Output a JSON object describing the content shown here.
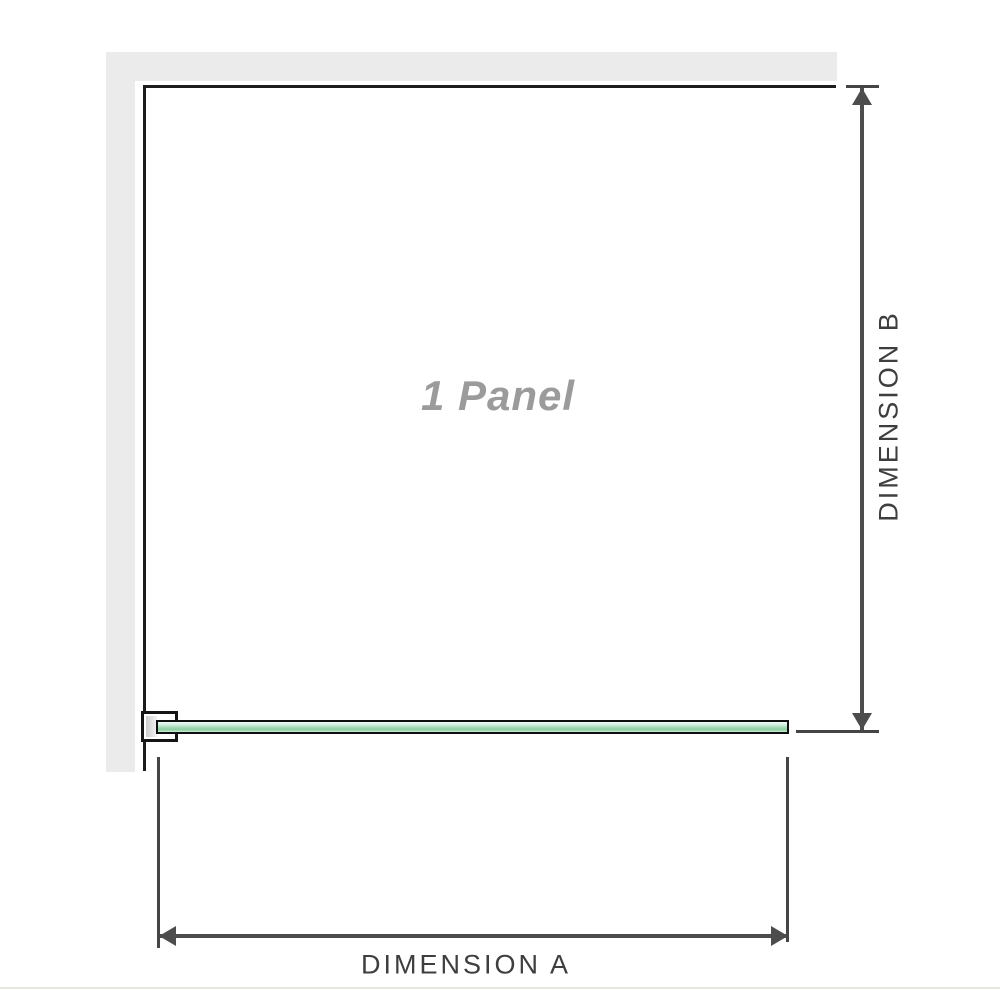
{
  "diagram": {
    "title": "shower panel dimension diagram",
    "panel_label": "1 Panel",
    "dimension_a_label": "DIMENSION A",
    "dimension_b_label": "DIMENSION B",
    "colors": {
      "background": "#ffffff",
      "wall_gray": "#ebebeb",
      "panel_outline": "#1c1c1c",
      "glass_green_light": "#cdeedd",
      "glass_green_mid": "#8fd0a0",
      "glass_border": "#0f0f0f",
      "clamp_border": "#151515",
      "clamp_pad_gray": "#d9d9d9",
      "dimension_line": "#4d4d4d",
      "dimension_text": "#3e3e3e",
      "panel_text": "#9b9b9b",
      "baseline_gray": "#e8e6e1"
    }
  }
}
